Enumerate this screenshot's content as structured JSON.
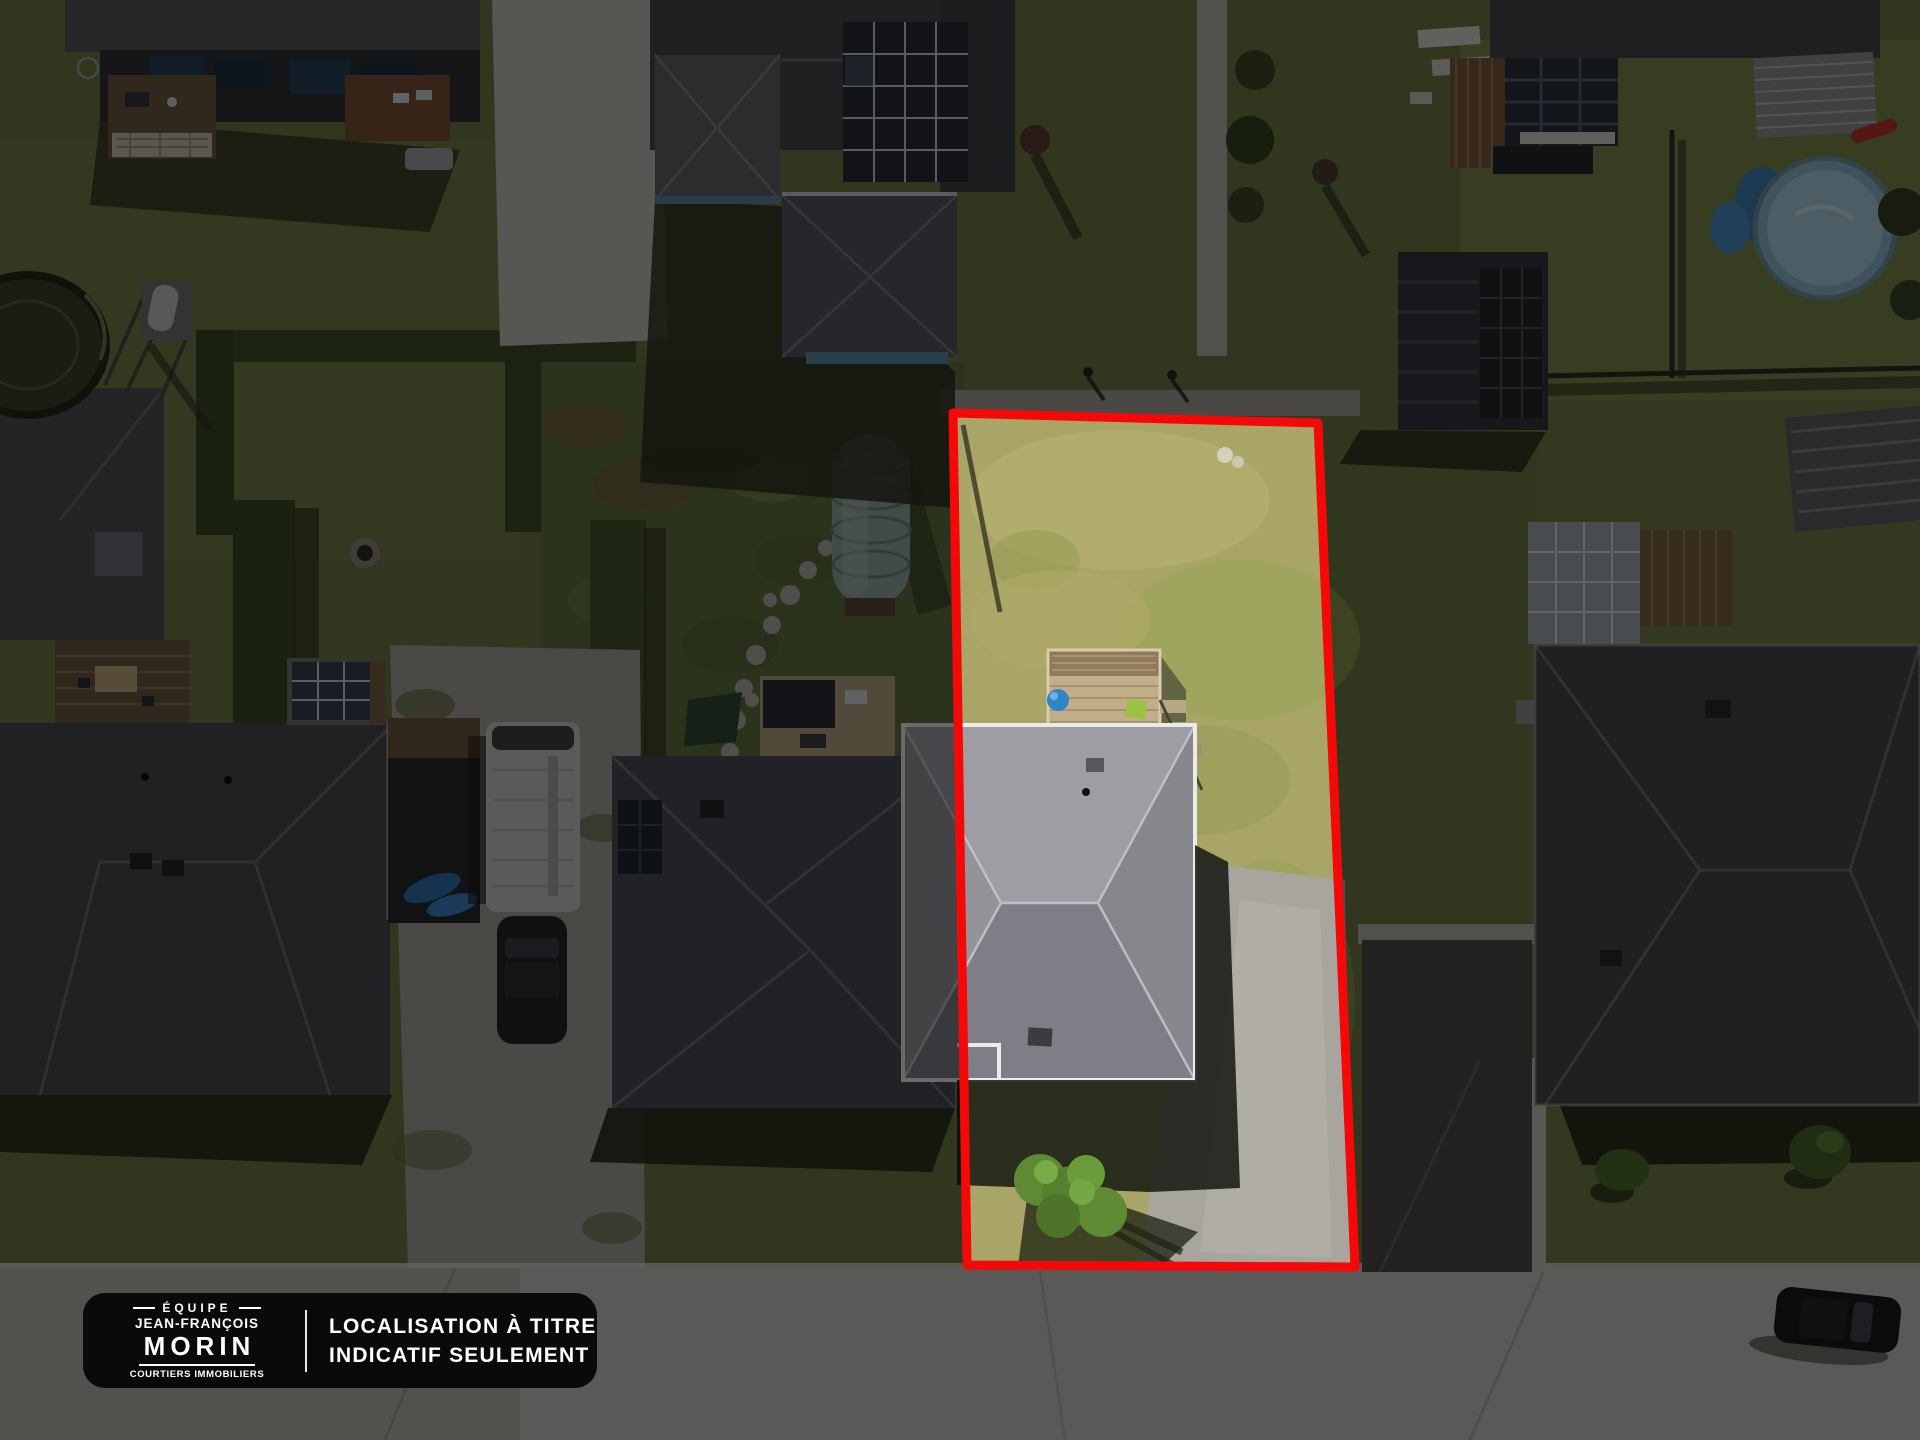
{
  "badge": {
    "team_prefix": "ÉQUIPE",
    "team_name_line1": "JEAN-FRANÇOIS",
    "team_name_line2": "MORIN",
    "team_subtitle": "COURTIERS IMMOBILIERS",
    "disclaimer_line1": "LOCALISATION À TITRE",
    "disclaimer_line2": "INDICATIF SEULEMENT"
  },
  "annotation": {
    "outline_color": "#F50808",
    "badge_background": "#0A0A0A",
    "badge_text_color": "#FFFFFF"
  }
}
